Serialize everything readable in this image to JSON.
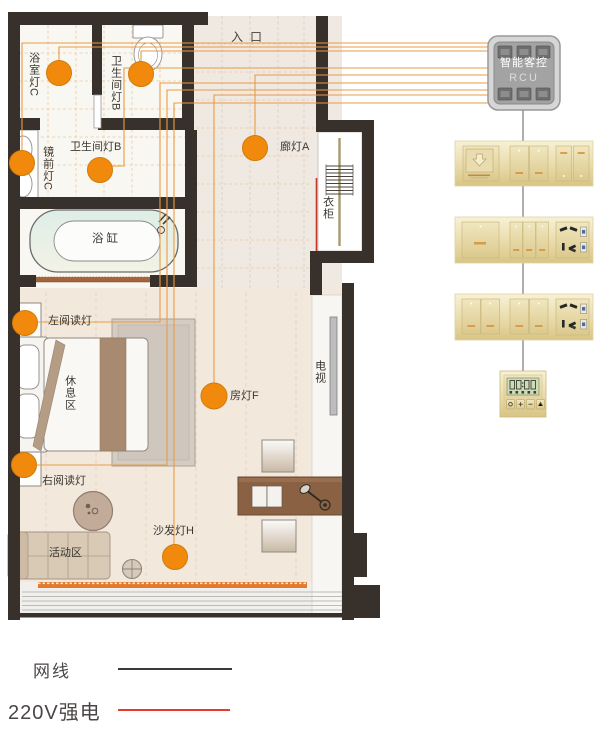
{
  "diagram": {
    "title_implicit": "酒店客房智能客控布线图",
    "rooms": {
      "entry": "入口",
      "bathtub": "浴缸",
      "wardrobe": "衣柜",
      "tv": "电视",
      "rest_area": "休息区",
      "activity_area": "活动区"
    },
    "lights": [
      {
        "id": "bathroom-light-c",
        "label": "浴室灯C"
      },
      {
        "id": "toilet-light-b-upper",
        "label": "卫生间灯B"
      },
      {
        "id": "mirror-light-c",
        "label": "镜前灯C"
      },
      {
        "id": "toilet-light-b",
        "label": "卫生间灯B"
      },
      {
        "id": "corridor-light-a",
        "label": "廊灯A"
      },
      {
        "id": "left-reading-light",
        "label": "左阅读灯"
      },
      {
        "id": "right-reading-light",
        "label": "右阅读灯"
      },
      {
        "id": "room-light-f",
        "label": "房灯F"
      },
      {
        "id": "sofa-light-h",
        "label": "沙发灯H"
      }
    ],
    "rcu": {
      "title": "智能客控",
      "subtitle": "RCU"
    },
    "devices": [
      {
        "id": "panel-card-power",
        "desc": "card-key power panel with switches"
      },
      {
        "id": "panel-switch-socket",
        "desc": "switch panel with 5-hole USB socket"
      },
      {
        "id": "panel-switches",
        "desc": "switch panel with 5-hole USB socket"
      },
      {
        "id": "thermostat",
        "desc": "LCD thermostat"
      }
    ],
    "legend": {
      "items": [
        {
          "id": "network-cable",
          "label": "网线",
          "color": "#3a3a3a"
        },
        {
          "id": "power-220v",
          "label": "220V强电",
          "color": "#e83a28"
        }
      ]
    },
    "colors": {
      "light_dot": "#f18a0c",
      "wire": "#e99c46",
      "wall": "#38302a",
      "panel_gold": "#e6d69c",
      "power_line": "#c0392b"
    }
  }
}
